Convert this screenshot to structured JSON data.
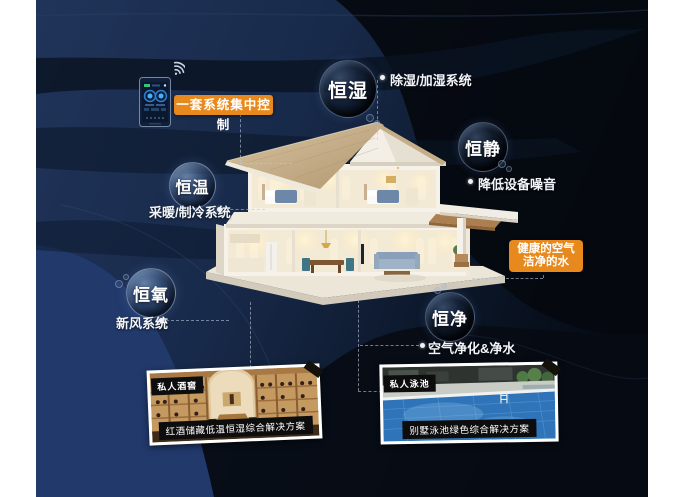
{
  "poster": {
    "title_hint": "smart-home five-constants infographic",
    "control_panel": {
      "label": "一套系统集中控制",
      "icons": [
        "thermostat-phone-icon",
        "wifi-icon"
      ]
    },
    "features": [
      {
        "name": "恒湿",
        "system": "除湿/加湿系统"
      },
      {
        "name": "恒静",
        "system": "降低设备噪音"
      },
      {
        "name": "恒温",
        "system": "采暖/制冷系统"
      },
      {
        "name": "恒氧",
        "system": "新风系统"
      },
      {
        "name": "恒净",
        "system": "空气净化&净水"
      }
    ],
    "highlight": {
      "line1": "健康的空气",
      "line2": "洁净的水"
    },
    "photos": [
      {
        "tag": "私人酒窖",
        "caption": "红酒储藏低温恒湿综合解决方案",
        "scene": "wine-cellar"
      },
      {
        "tag": "私人泳池",
        "caption": "别墅泳池绿色综合解决方案",
        "scene": "swimming-pool"
      }
    ],
    "colors": {
      "accent_orange": "#E8891E",
      "background_navy": "#1D3154",
      "deep_black": "#05080F",
      "bubble_text": "#FFFFFF"
    }
  }
}
